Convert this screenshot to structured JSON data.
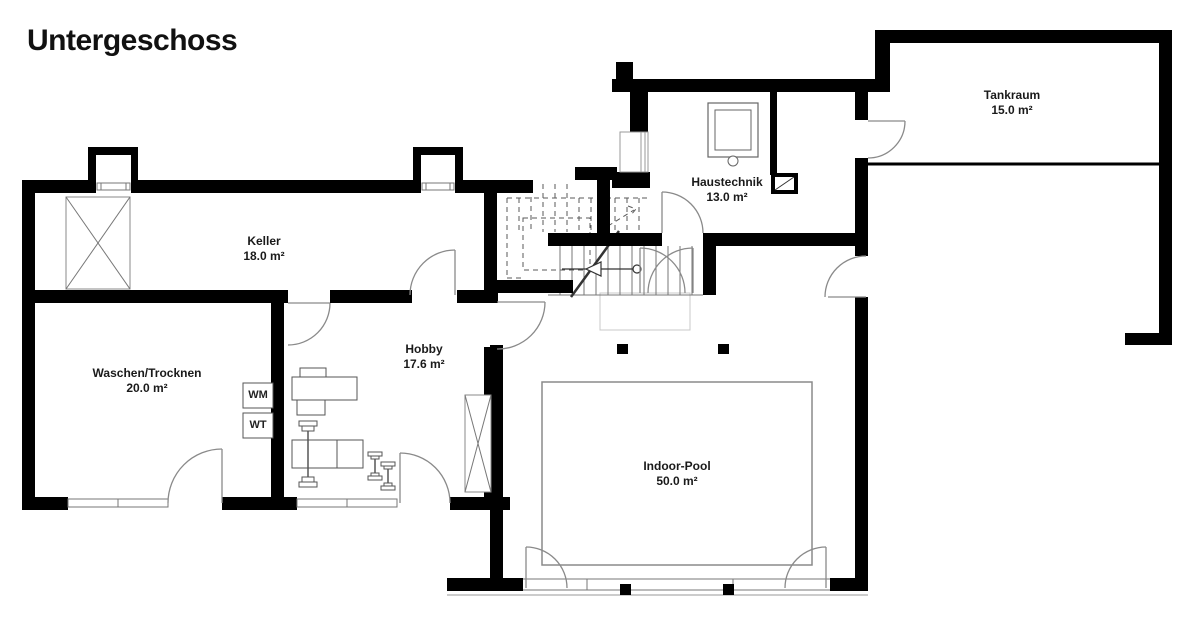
{
  "title": "Untergeschoss",
  "rooms": [
    {
      "id": "keller",
      "name": "Keller",
      "area": "18.0 m²"
    },
    {
      "id": "waschen",
      "name": "Waschen/Trocknen",
      "area": "20.0 m²"
    },
    {
      "id": "hobby",
      "name": "Hobby",
      "area": "17.6 m²"
    },
    {
      "id": "haustechnik",
      "name": "Haustechnik",
      "area": "13.0 m²"
    },
    {
      "id": "tankraum",
      "name": "Tankraum",
      "area": "15.0 m²"
    },
    {
      "id": "pool",
      "name": "Indoor-Pool",
      "area": "50.0 m²"
    }
  ],
  "appliances": {
    "wm": "WM",
    "wt": "WT"
  },
  "icons": [
    "stair-direction-arrow-icon",
    "boiler-icon",
    "shaft-icon",
    "lightwell-icon"
  ],
  "colors": {
    "wall": "#000000",
    "door_swing": "#8a8a8a",
    "thin_line": "#777777",
    "background": "#ffffff"
  }
}
